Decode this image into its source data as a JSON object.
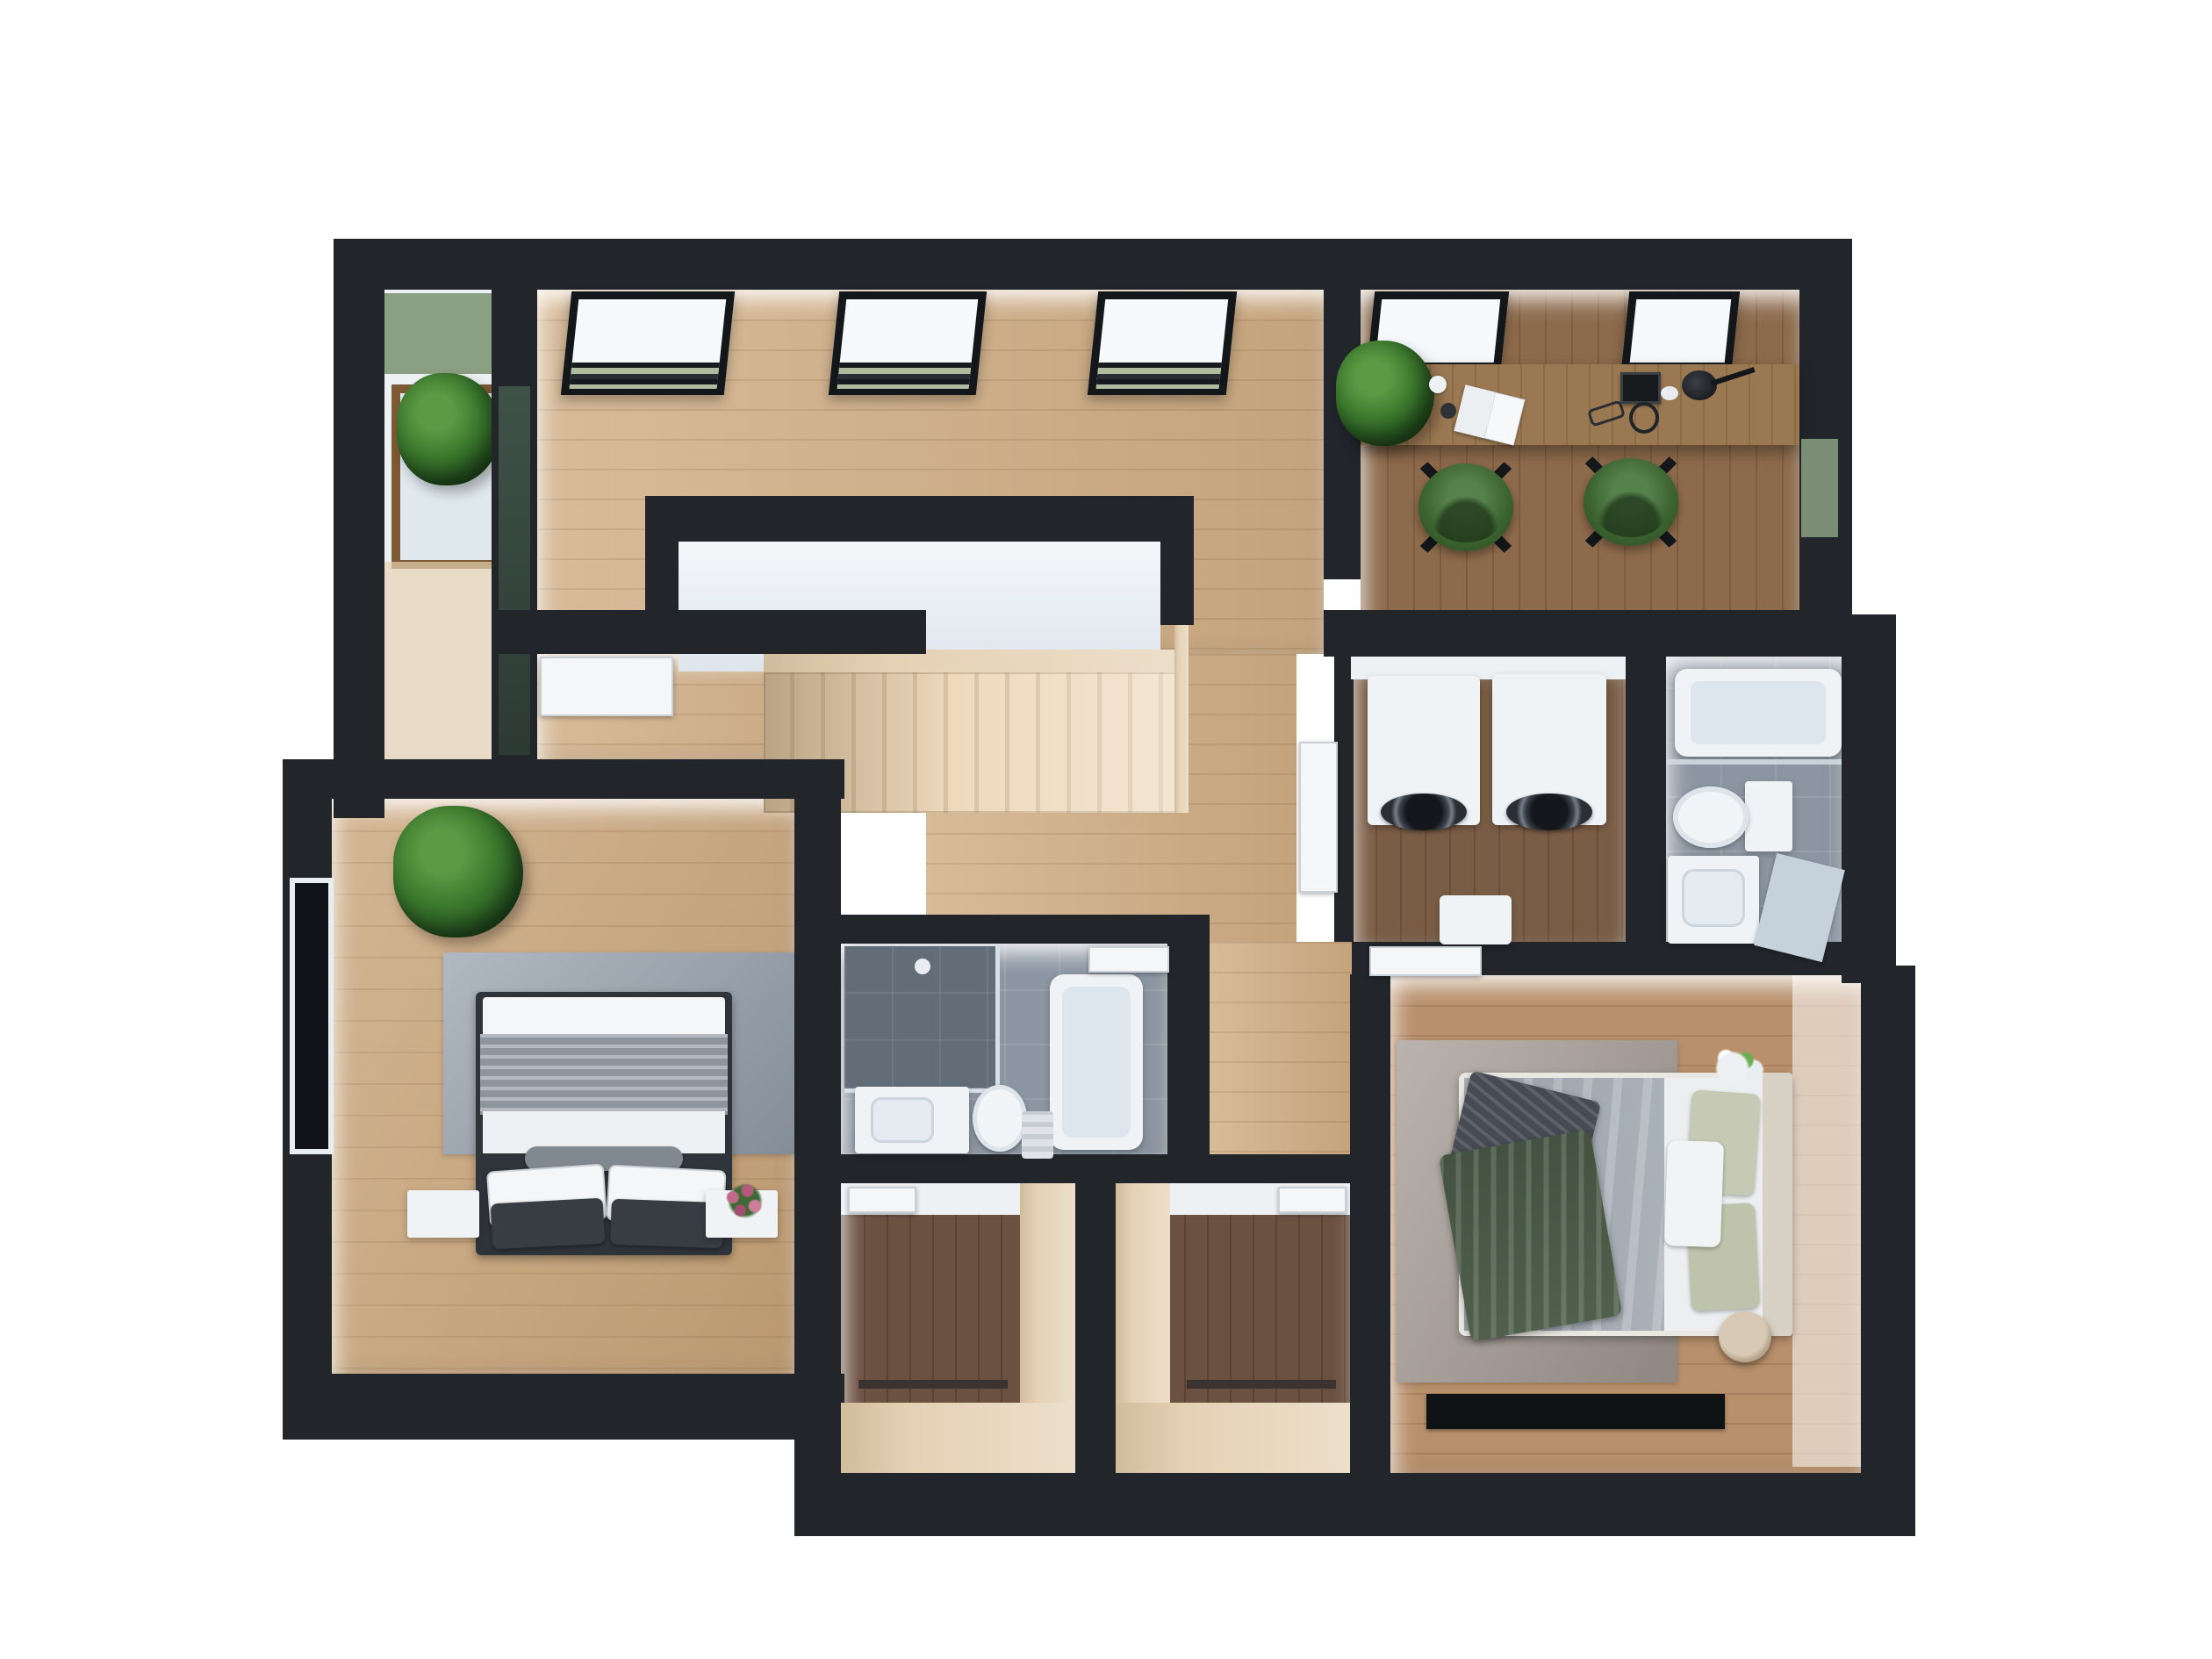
{
  "meta": {
    "title": "3D cutaway floor plan — upper storey",
    "render_style": "top-down axonometric architectural visualization",
    "visible_text": "none"
  },
  "palette": {
    "wall": "#22262b",
    "oak": "#cfac83",
    "oak_bedroom": "#c7a276",
    "master_floor": "#b8906b",
    "office_floor": "#8d6a4b",
    "laundry_floor": "#7a5d45",
    "closet_floor": "#6b5140",
    "tile": "#8c96a2",
    "tile_dark": "#636d78",
    "wood_light": "#e5d1b4",
    "desk": "#9a7852",
    "chair_green": "#3c632f",
    "plant_green": "#3c7a2e",
    "sage": "#8ba083",
    "rug_blue": "#96a1ad",
    "rug_taupe": "#a79d96",
    "white_fix": "#f0f3f6",
    "duvet_grey": "#aab2b9",
    "throw_green": "#50604c",
    "pillow_sage": "#c6c9b3",
    "dark_fabric": "#474c54",
    "glass": "#cfd9e0",
    "background": "#ffffff"
  },
  "rooms": [
    {
      "id": "loggia",
      "name": "Plant loggia",
      "features": [
        "sage green wall",
        "timber-framed window",
        "potted plant"
      ]
    },
    {
      "id": "landing-hall",
      "name": "Skylit landing hall",
      "skylights": 3,
      "floor": "light oak"
    },
    {
      "id": "home-office",
      "name": "Home office",
      "skylights": 2,
      "furniture": [
        "long wooden desk",
        "two green swivel chairs",
        "potted plant",
        "open notebook",
        "book",
        "desk lamp",
        "headphones",
        "glasses",
        "two cups"
      ]
    },
    {
      "id": "stairwell",
      "name": "Staircase with open void",
      "features": [
        "timber flight",
        "balustrade half-wall",
        "railing"
      ]
    },
    {
      "id": "inner-room",
      "name": "Inner vestibule room",
      "features": [
        "white door"
      ]
    },
    {
      "id": "laundry",
      "name": "Laundry room",
      "furniture": [
        "washing machine",
        "tumble dryer",
        "laundry hamper"
      ]
    },
    {
      "id": "bathroom",
      "name": "Bathroom",
      "furniture": [
        "bathtub with shower screen",
        "toilet",
        "vanity basin",
        "mirror"
      ]
    },
    {
      "id": "bedroom-2",
      "name": "Bedroom 2",
      "furniture": [
        "double bed",
        "grey knit blanket",
        "two white pillows",
        "two charcoal pillows",
        "bolster",
        "two nightstands",
        "flower vase",
        "blue-grey rug",
        "potted plant",
        "window"
      ]
    },
    {
      "id": "ensuite",
      "name": "En-suite bathroom",
      "furniture": [
        "walk-in shower",
        "vanity basin",
        "toilet",
        "bathtub",
        "towel"
      ]
    },
    {
      "id": "closet-1",
      "name": "Walk-in closet 1",
      "furniture": [
        "light-wood wardrobe unit",
        "clothes rail"
      ]
    },
    {
      "id": "closet-2",
      "name": "Walk-in closet 2",
      "furniture": [
        "light-wood wardrobe unit",
        "clothes rail"
      ]
    },
    {
      "id": "master-bedroom",
      "name": "Master bedroom",
      "furniture": [
        "king bed",
        "grey duvet",
        "green velvet throw",
        "knit cushion",
        "sage pillows",
        "white pillow",
        "round side table",
        "flower vase",
        "taupe rug",
        "dark floor mat"
      ]
    },
    {
      "id": "corridor",
      "name": "Corridor",
      "features": [
        "oak floor",
        "white doors to rooms"
      ]
    }
  ],
  "architecture": {
    "walls": "thick charcoal-black cut walls",
    "skylight_count_total": 5,
    "doors_visible": 6,
    "windows_visible": [
      "loggia timber window",
      "bedroom-2 left window",
      "office right sage window",
      "glazed hall partition"
    ]
  }
}
